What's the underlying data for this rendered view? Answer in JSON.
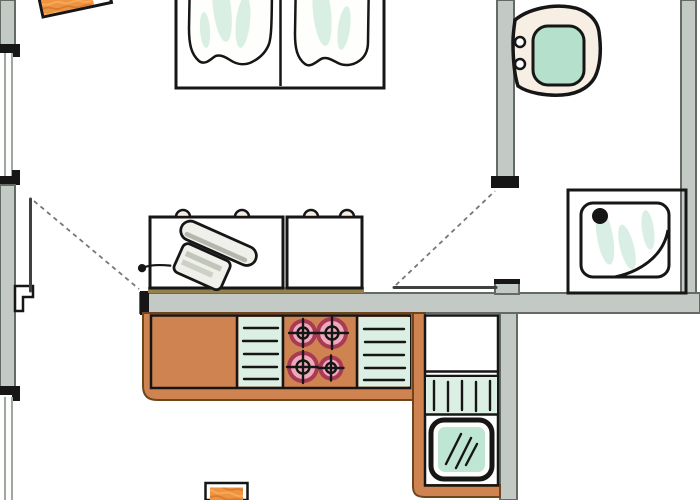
{
  "page": {
    "title": "hand-drawn apartment floor plan"
  },
  "colors": {
    "paper": "#ffffff",
    "wall_fill": "#c3c9c5",
    "wall_edge": "#646b64",
    "outline": "#161616",
    "window_line": "#9fa7a1",
    "leaf": "#3e423e",
    "swing": "#747974",
    "desk_red": "#e5411e",
    "desk_red_dark": "#bd2d09",
    "desk_red_light": "#f46a3c",
    "orange": "#ee9440",
    "orange_dark": "#d06f24",
    "orange_light": "#ffb870",
    "bedding_orange": "#df7f3c",
    "bedding_orange_dark": "#c05d1d",
    "bedding_orange_light": "#ef9c5e",
    "counter_orange": "#cf8350",
    "counter_edge": "#6f451e",
    "teal": "#b4e0cc",
    "teal_soft": "#dcefe5",
    "cream": "#f7efe4",
    "burner_fill": "#eeaabb",
    "burner_ring": "#a93a55",
    "metal_light": "#f0f0ea",
    "metal_mid": "#c2c6ba",
    "metal_dark": "#85897e",
    "strip_olive": "#92804d"
  },
  "fixtures": {
    "plan": {
      "label": "hand-drawn apartment floor plan"
    },
    "bed": {
      "label": "double bed with two duvets"
    },
    "nightstand": {
      "label": "nightstand"
    },
    "desk": {
      "label": "red sideboard with telephone"
    },
    "phone": {
      "label": "telephone"
    },
    "toilet": {
      "label": "toilet"
    },
    "shower": {
      "label": "shower tray with drain"
    },
    "counter": {
      "label": "kitchen counter"
    },
    "counter_left": {
      "label": "counter / sink section"
    },
    "drainboard_left": {
      "label": "drainboard"
    },
    "stove": {
      "label": "stove with four burners"
    },
    "drainboard_right": {
      "label": "drainboard"
    },
    "corner_unit": {
      "label": "kitchen corner unit"
    },
    "upper_cabinet": {
      "label": "cabinet"
    },
    "dish_rack": {
      "label": "dish rack"
    },
    "oven": {
      "label": "appliance with glass door"
    },
    "stool": {
      "label": "stool"
    },
    "door_left": {
      "label": "room door"
    },
    "door_bath": {
      "label": "bathroom door"
    },
    "window_top": {
      "label": "window"
    },
    "window_bottom": {
      "label": "window"
    },
    "walls": {
      "label": "walls"
    }
  }
}
